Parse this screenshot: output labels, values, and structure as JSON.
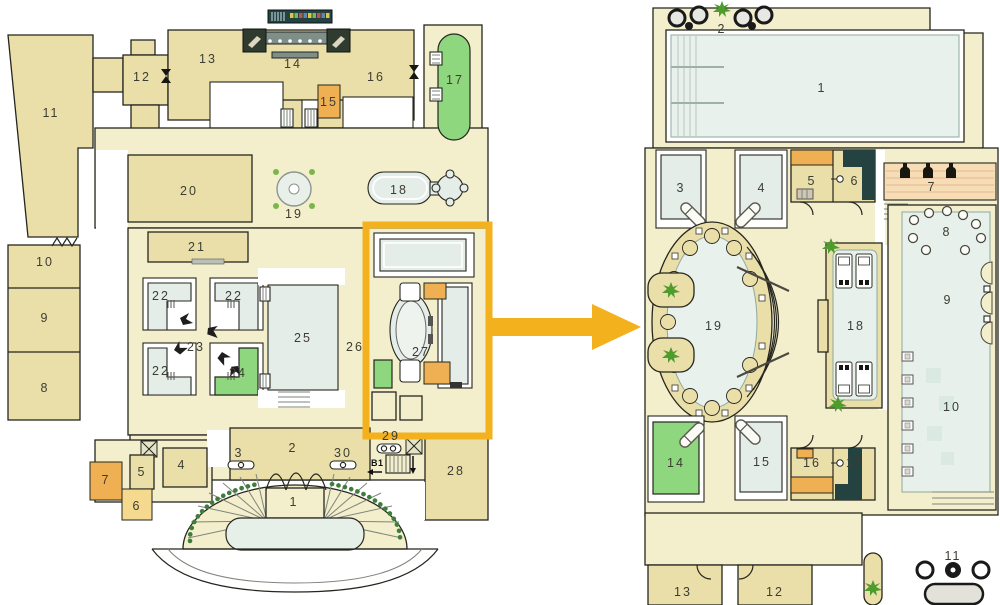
{
  "figure": {
    "type": "floor-plan-with-detail",
    "highlight_color": "#f3b11d"
  },
  "colors": {
    "floor": "#f3eecb",
    "room_beige": "#eadfa9",
    "room_blue": "#e4ede8",
    "water": "#e9f1ec",
    "accent_green": "#8fd77e",
    "accent_orange": "#efb054",
    "accent_orange_light": "#f5d98e",
    "dark_teal": "#24423f",
    "highlight": "#f3b11d",
    "wall": "#26261f",
    "plant_green": "#4e9b2e",
    "stair_dot_green": "#3f7d3a",
    "stripe_peach": "#f7ddb5"
  },
  "left_plan": {
    "rooms": {
      "r1": "1",
      "r2": "2",
      "r3": "3",
      "r4": "4",
      "r5": "5",
      "r6": "6",
      "r7": "7",
      "r8": "8",
      "r9": "9",
      "r10": "10",
      "r11": "11",
      "r12": "12",
      "r13": "13",
      "r14": "14",
      "r15": "15",
      "r16": "16",
      "r17": "17",
      "r18": "18",
      "r19": "19",
      "r20": "20",
      "r21": "21",
      "r22a": "22",
      "r22b": "22",
      "r22c": "22",
      "r23": "23",
      "r24": "24",
      "r25": "25",
      "r26": "26",
      "r27": "27",
      "r28": "28",
      "r29": "29",
      "r30": "30"
    },
    "basement_label": "B1"
  },
  "right_plan": {
    "rooms": {
      "r1": "1",
      "r2": "2",
      "r3": "3",
      "r4": "4",
      "r5": "5",
      "r6": "6",
      "r7": "7",
      "r8": "8",
      "r9": "9",
      "r10": "10",
      "r11": "11",
      "r12": "12",
      "r13": "13",
      "r14": "14",
      "r15": "15",
      "r16": "16",
      "r17": "17",
      "r18": "18",
      "r19": "19"
    }
  },
  "icons": {
    "plant": "plant-icon",
    "bottle": "bottle-icon",
    "bed": "massage-bed-icon",
    "lounger": "lounger-icon",
    "elevator": "elevator-icon",
    "stairs": "stairs-icon",
    "arrow": "zoom-arrow-icon"
  }
}
